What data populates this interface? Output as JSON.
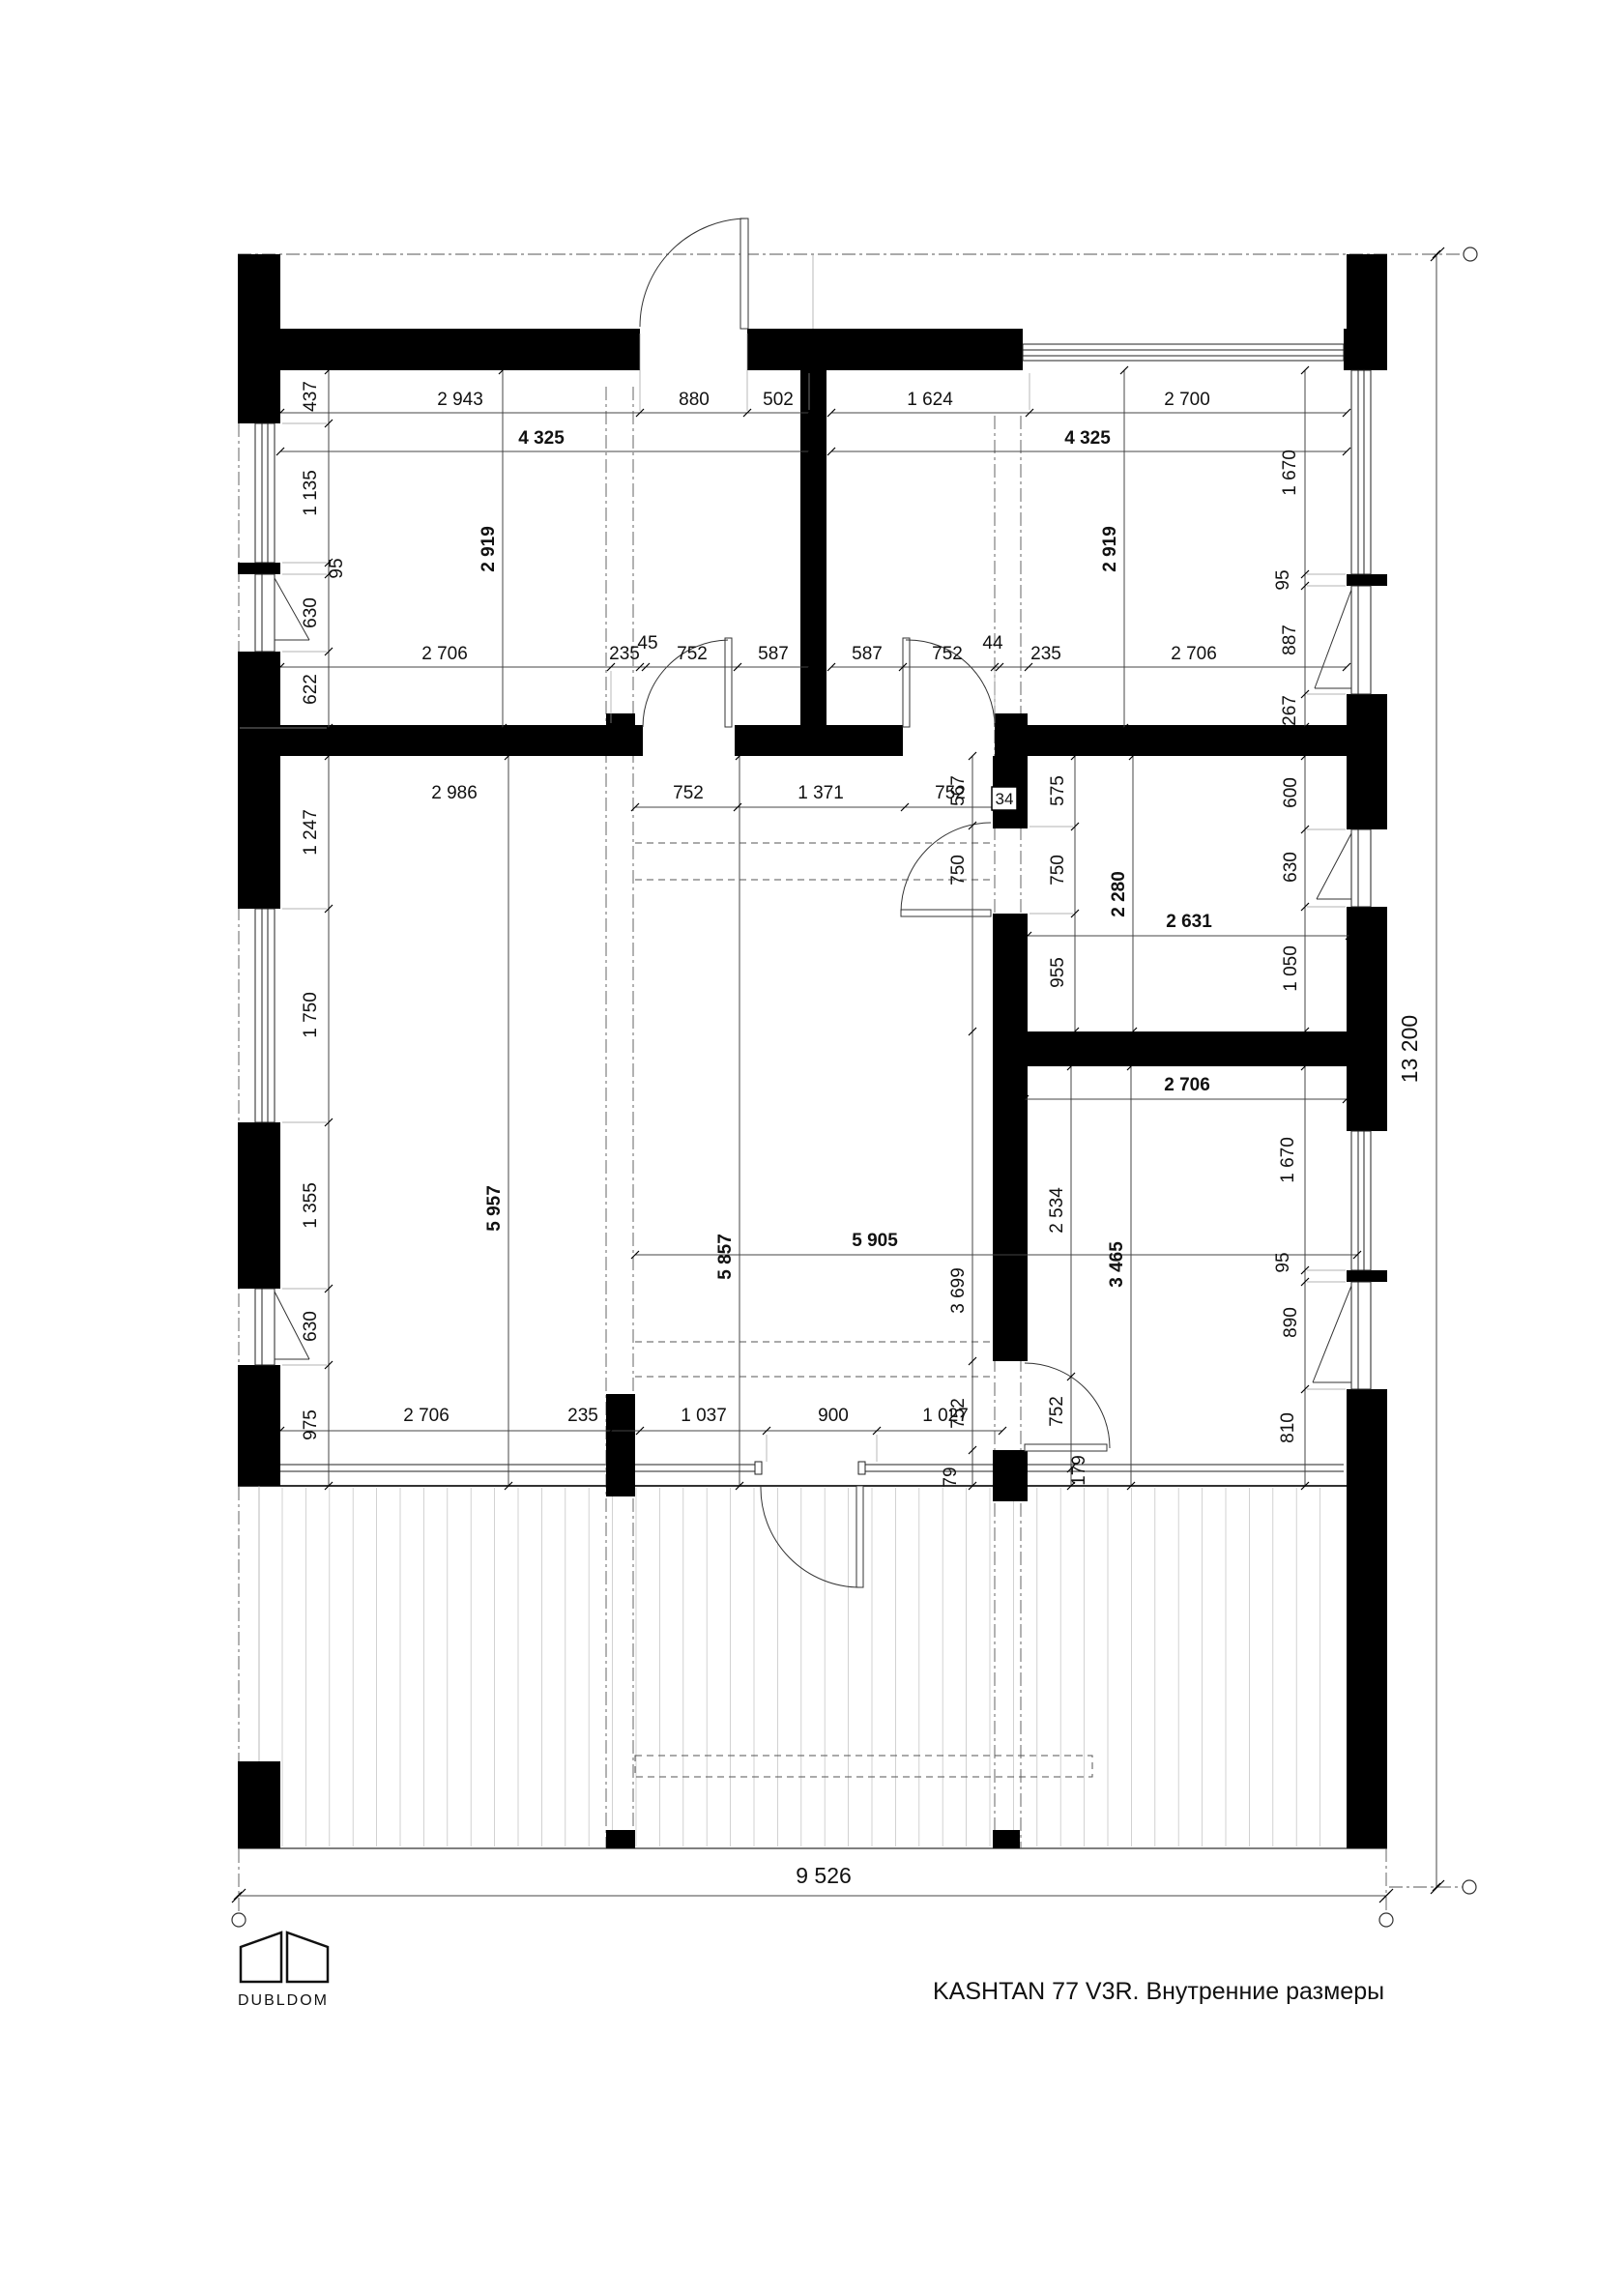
{
  "title": "KASHTAN 77 V3R. Внутренние размеры",
  "logo": {
    "brand": "DUBLDOM"
  },
  "overall": {
    "width": "9 526",
    "height": "13 200"
  },
  "rooms": {
    "bedroom1_width": "4 325",
    "bedroom1_height": "2 919",
    "bedroom2_width": "4 325",
    "bedroom2_height": "2 919",
    "bath_width": "2 631",
    "bath_height": "2 280",
    "living_height": "5 957",
    "hall_height": "5 857",
    "hall_width": "5 905",
    "bedroom3_width": "2 706",
    "bedroom3_height": "3 465"
  },
  "dims": {
    "top_row_left": [
      "2 943",
      "880",
      "502"
    ],
    "top_row_right": [
      "1 624",
      "2 700"
    ],
    "left_wall_chain": [
      "437",
      "1 135",
      "95",
      "630",
      "622"
    ],
    "right_wall_chain": [
      "1 670",
      "95",
      "887",
      "267"
    ],
    "row2_left": [
      "2 706",
      "235",
      "45",
      "752",
      "587"
    ],
    "row2_right": [
      "587",
      "752",
      "44",
      "235",
      "2 706"
    ],
    "hall_row": [
      "2 986",
      "752",
      "1 371",
      "752"
    ],
    "v567": "567",
    "wall34": "34",
    "bath_left_chain": [
      "575",
      "750",
      "955"
    ],
    "hall_750": "750",
    "bath_right_chain": [
      "600",
      "630",
      "1 050"
    ],
    "living_left_chain": [
      "1 247",
      "1 750",
      "1 355",
      "630",
      "975"
    ],
    "hall_3699": "3 699",
    "living_bottom_row": [
      "2 706",
      "235",
      "1 037",
      "900",
      "1 027"
    ],
    "bed3_west_chain": [
      "2 534",
      "752",
      "179"
    ],
    "bed3_east_chain": [
      "1 670",
      "95",
      "890",
      "810"
    ],
    "door_752_hall": "752",
    "v79": "79"
  }
}
